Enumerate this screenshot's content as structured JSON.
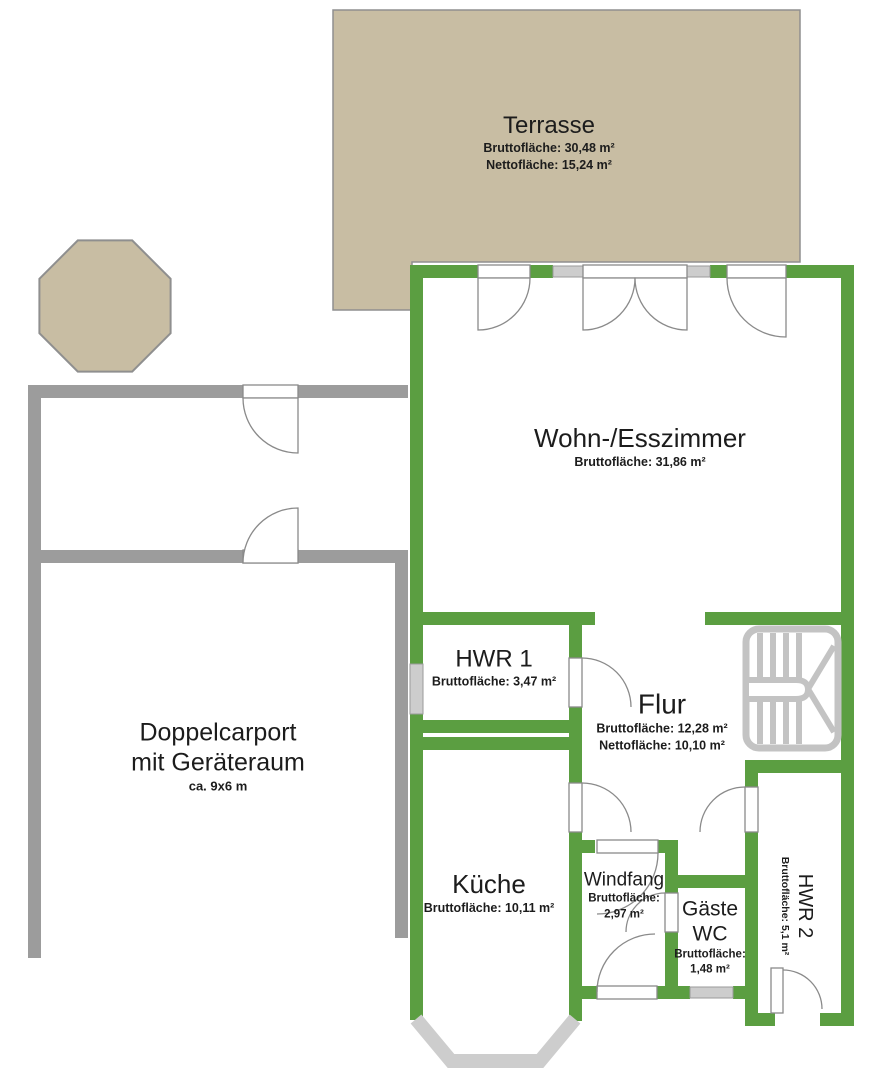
{
  "plan": {
    "terrasse": {
      "name": "Terrasse",
      "brutto": "Bruttofläche: 30,48 m²",
      "netto": "Nettofläche: 15,24 m²"
    },
    "wohn_esszimmer": {
      "name": "Wohn-/Esszimmer",
      "brutto": "Bruttofläche: 31,86 m²"
    },
    "hwr1": {
      "name": "HWR 1",
      "brutto": "Bruttofläche: 3,47 m²"
    },
    "flur": {
      "name": "Flur",
      "brutto": "Bruttofläche: 12,28 m²",
      "netto": "Nettofläche: 10,10 m²"
    },
    "kueche": {
      "name": "Küche",
      "brutto": "Bruttofläche: 10,11 m²"
    },
    "windfang": {
      "name": "Windfang",
      "brutto_label": "Bruttofläche:",
      "brutto_value": "2,97 m²"
    },
    "gaeste_wc": {
      "name_line1": "Gäste",
      "name_line2": "WC",
      "brutto_label": "Bruttofläche:",
      "brutto_value": "1,48 m²"
    },
    "hwr2": {
      "name": "HWR 2",
      "brutto": "Bruttofläche: 5,1 m²"
    },
    "carport": {
      "name_line1": "Doppelcarport",
      "name_line2": "mit Geräteraum",
      "size": "ca. 9x6 m"
    }
  },
  "colors": {
    "wall_green": "#5b9e41",
    "carport_gray": "#9c9c9c",
    "window_gray": "#cdcdcd",
    "terrace_beige": "#c8bda3",
    "stairs_gray": "#c3c3c3",
    "door_stroke": "#8a8a8a"
  }
}
